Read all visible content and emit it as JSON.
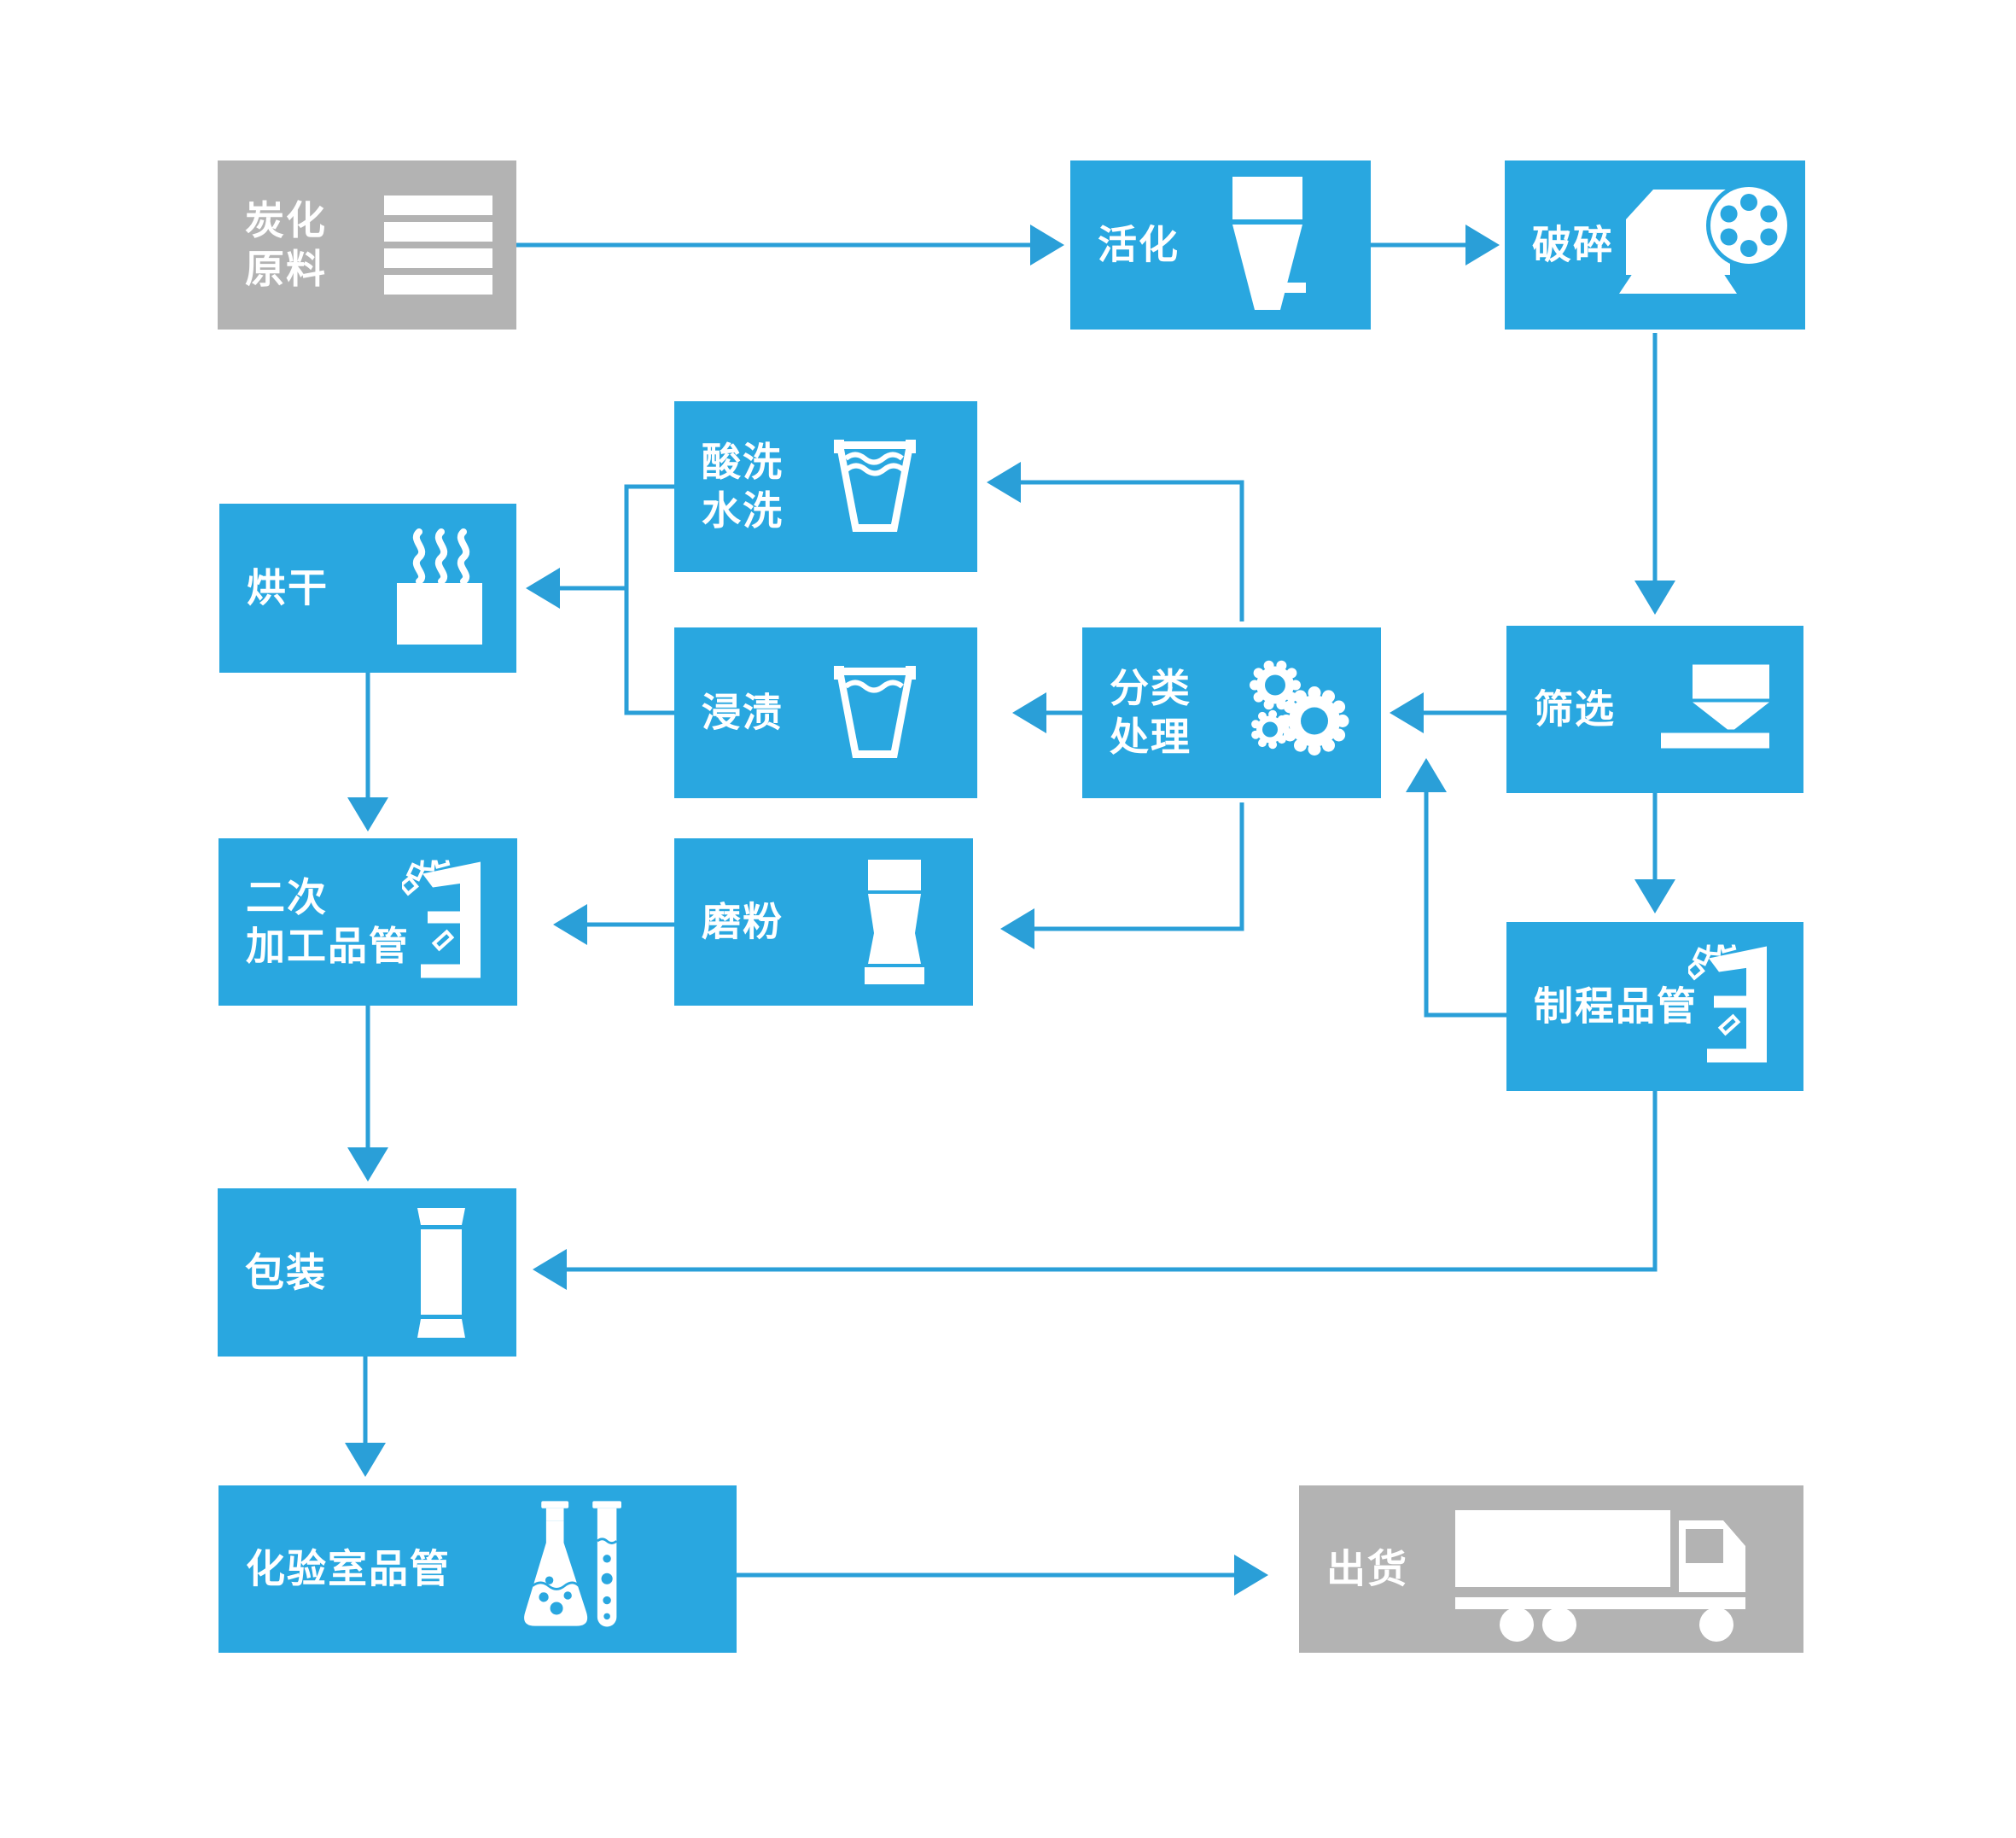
{
  "colors": {
    "box_blue": "#29a7e0",
    "box_gray": "#b3b3b3",
    "line_blue": "#2a9fd8",
    "text": "#ffffff",
    "background": "#ffffff"
  },
  "nodes": {
    "raw_material": {
      "label": "炭化\n原料",
      "icon": "layers-icon"
    },
    "activation": {
      "label": "活化",
      "icon": "kiln-icon"
    },
    "crushing": {
      "label": "破碎",
      "icon": "crusher-icon"
    },
    "acid_wash": {
      "label": "酸洗\n水洗",
      "icon": "wash-glass-icon"
    },
    "drying": {
      "label": "烘干",
      "icon": "steam-dryer-icon"
    },
    "impregnation": {
      "label": "浸渍",
      "icon": "soak-glass-icon"
    },
    "classification": {
      "label": "分类\n处理",
      "icon": "gears-icon"
    },
    "screening": {
      "label": "筛选",
      "icon": "hopper-icon"
    },
    "secondary_qc": {
      "label": "二次\n加工品管",
      "icon": "microscope-icon"
    },
    "grinding": {
      "label": "磨粉",
      "icon": "grinder-icon"
    },
    "process_qc": {
      "label": "制程品管",
      "icon": "microscope-icon"
    },
    "packing": {
      "label": "包装",
      "icon": "package-icon"
    },
    "lab_qc": {
      "label": "化验室品管",
      "icon": "flask-tube-icon"
    },
    "shipping": {
      "label": "出货",
      "icon": "truck-icon"
    }
  },
  "edges": [
    {
      "from": "raw_material",
      "to": "activation"
    },
    {
      "from": "activation",
      "to": "crushing"
    },
    {
      "from": "crushing",
      "to": "screening"
    },
    {
      "from": "screening",
      "to": "classification"
    },
    {
      "from": "classification",
      "to": "acid_wash"
    },
    {
      "from": "classification",
      "to": "impregnation"
    },
    {
      "from": "acid_wash",
      "to": "drying"
    },
    {
      "from": "impregnation",
      "to": "drying"
    },
    {
      "from": "drying",
      "to": "secondary_qc"
    },
    {
      "from": "classification",
      "to": "grinding"
    },
    {
      "from": "grinding",
      "to": "secondary_qc"
    },
    {
      "from": "secondary_qc",
      "to": "packing"
    },
    {
      "from": "screening",
      "to": "process_qc"
    },
    {
      "from": "process_qc",
      "to": "classification"
    },
    {
      "from": "process_qc",
      "to": "packing"
    },
    {
      "from": "packing",
      "to": "lab_qc"
    },
    {
      "from": "lab_qc",
      "to": "shipping"
    }
  ]
}
